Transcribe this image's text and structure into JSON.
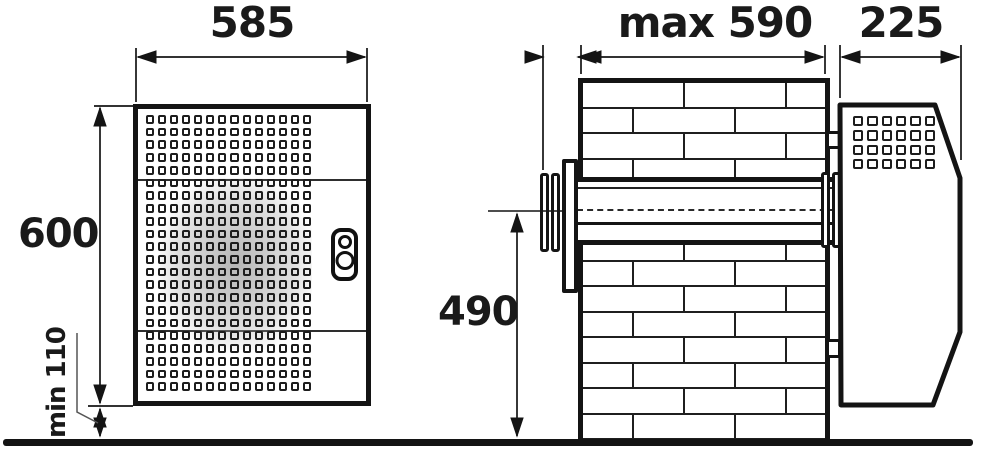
{
  "drawing": {
    "background": "#ffffff",
    "line_color": "#141414",
    "shading_color": "#a8a8a8",
    "labels": {
      "front_width": "585",
      "front_height": "600",
      "floor_clearance": "min 110",
      "wall_thickness": "max 590",
      "unit_depth": "225",
      "axis_height": "490"
    },
    "front_view": {
      "description": "indoor-panel-front-view",
      "grille": {
        "rows": 22,
        "cols": 14
      },
      "control": "thermostat-indicator"
    },
    "side_view": {
      "description": "through-wall-section-view",
      "grille": {
        "rows": 4,
        "cols": 6
      },
      "wall": {
        "brick_rows": 15,
        "brick_width": 102,
        "row_height": 25.5,
        "odd_row_offset": -51
      }
    }
  }
}
